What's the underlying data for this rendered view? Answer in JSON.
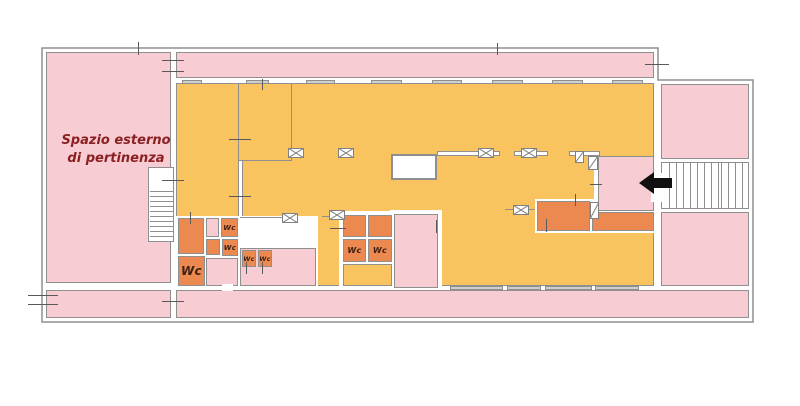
{
  "plan": {
    "type": "floor-plan",
    "outdoor_label_line1": "Spazio esterno",
    "outdoor_label_line2": "di pertinenza",
    "wc_label": "Wc",
    "wc_room_count": 7,
    "features": [
      "left-staircase",
      "right-staircase",
      "entrance-arrow",
      "elevator-box",
      "light-well"
    ]
  },
  "icons": {
    "entrance_arrow": "arrow-left",
    "column_marker": "crossed-box",
    "door_marker": "door-leaf"
  },
  "colors": {
    "outside": "#ffffff",
    "pink": "#f8ccd3",
    "orange": "#f9c45f",
    "dark": "#ec8950",
    "wall": "#8f8f8f",
    "sill": "#cfcfcf",
    "text_red": "#8b2023",
    "wc_text": "#3f2014",
    "arrow": "#111111"
  }
}
